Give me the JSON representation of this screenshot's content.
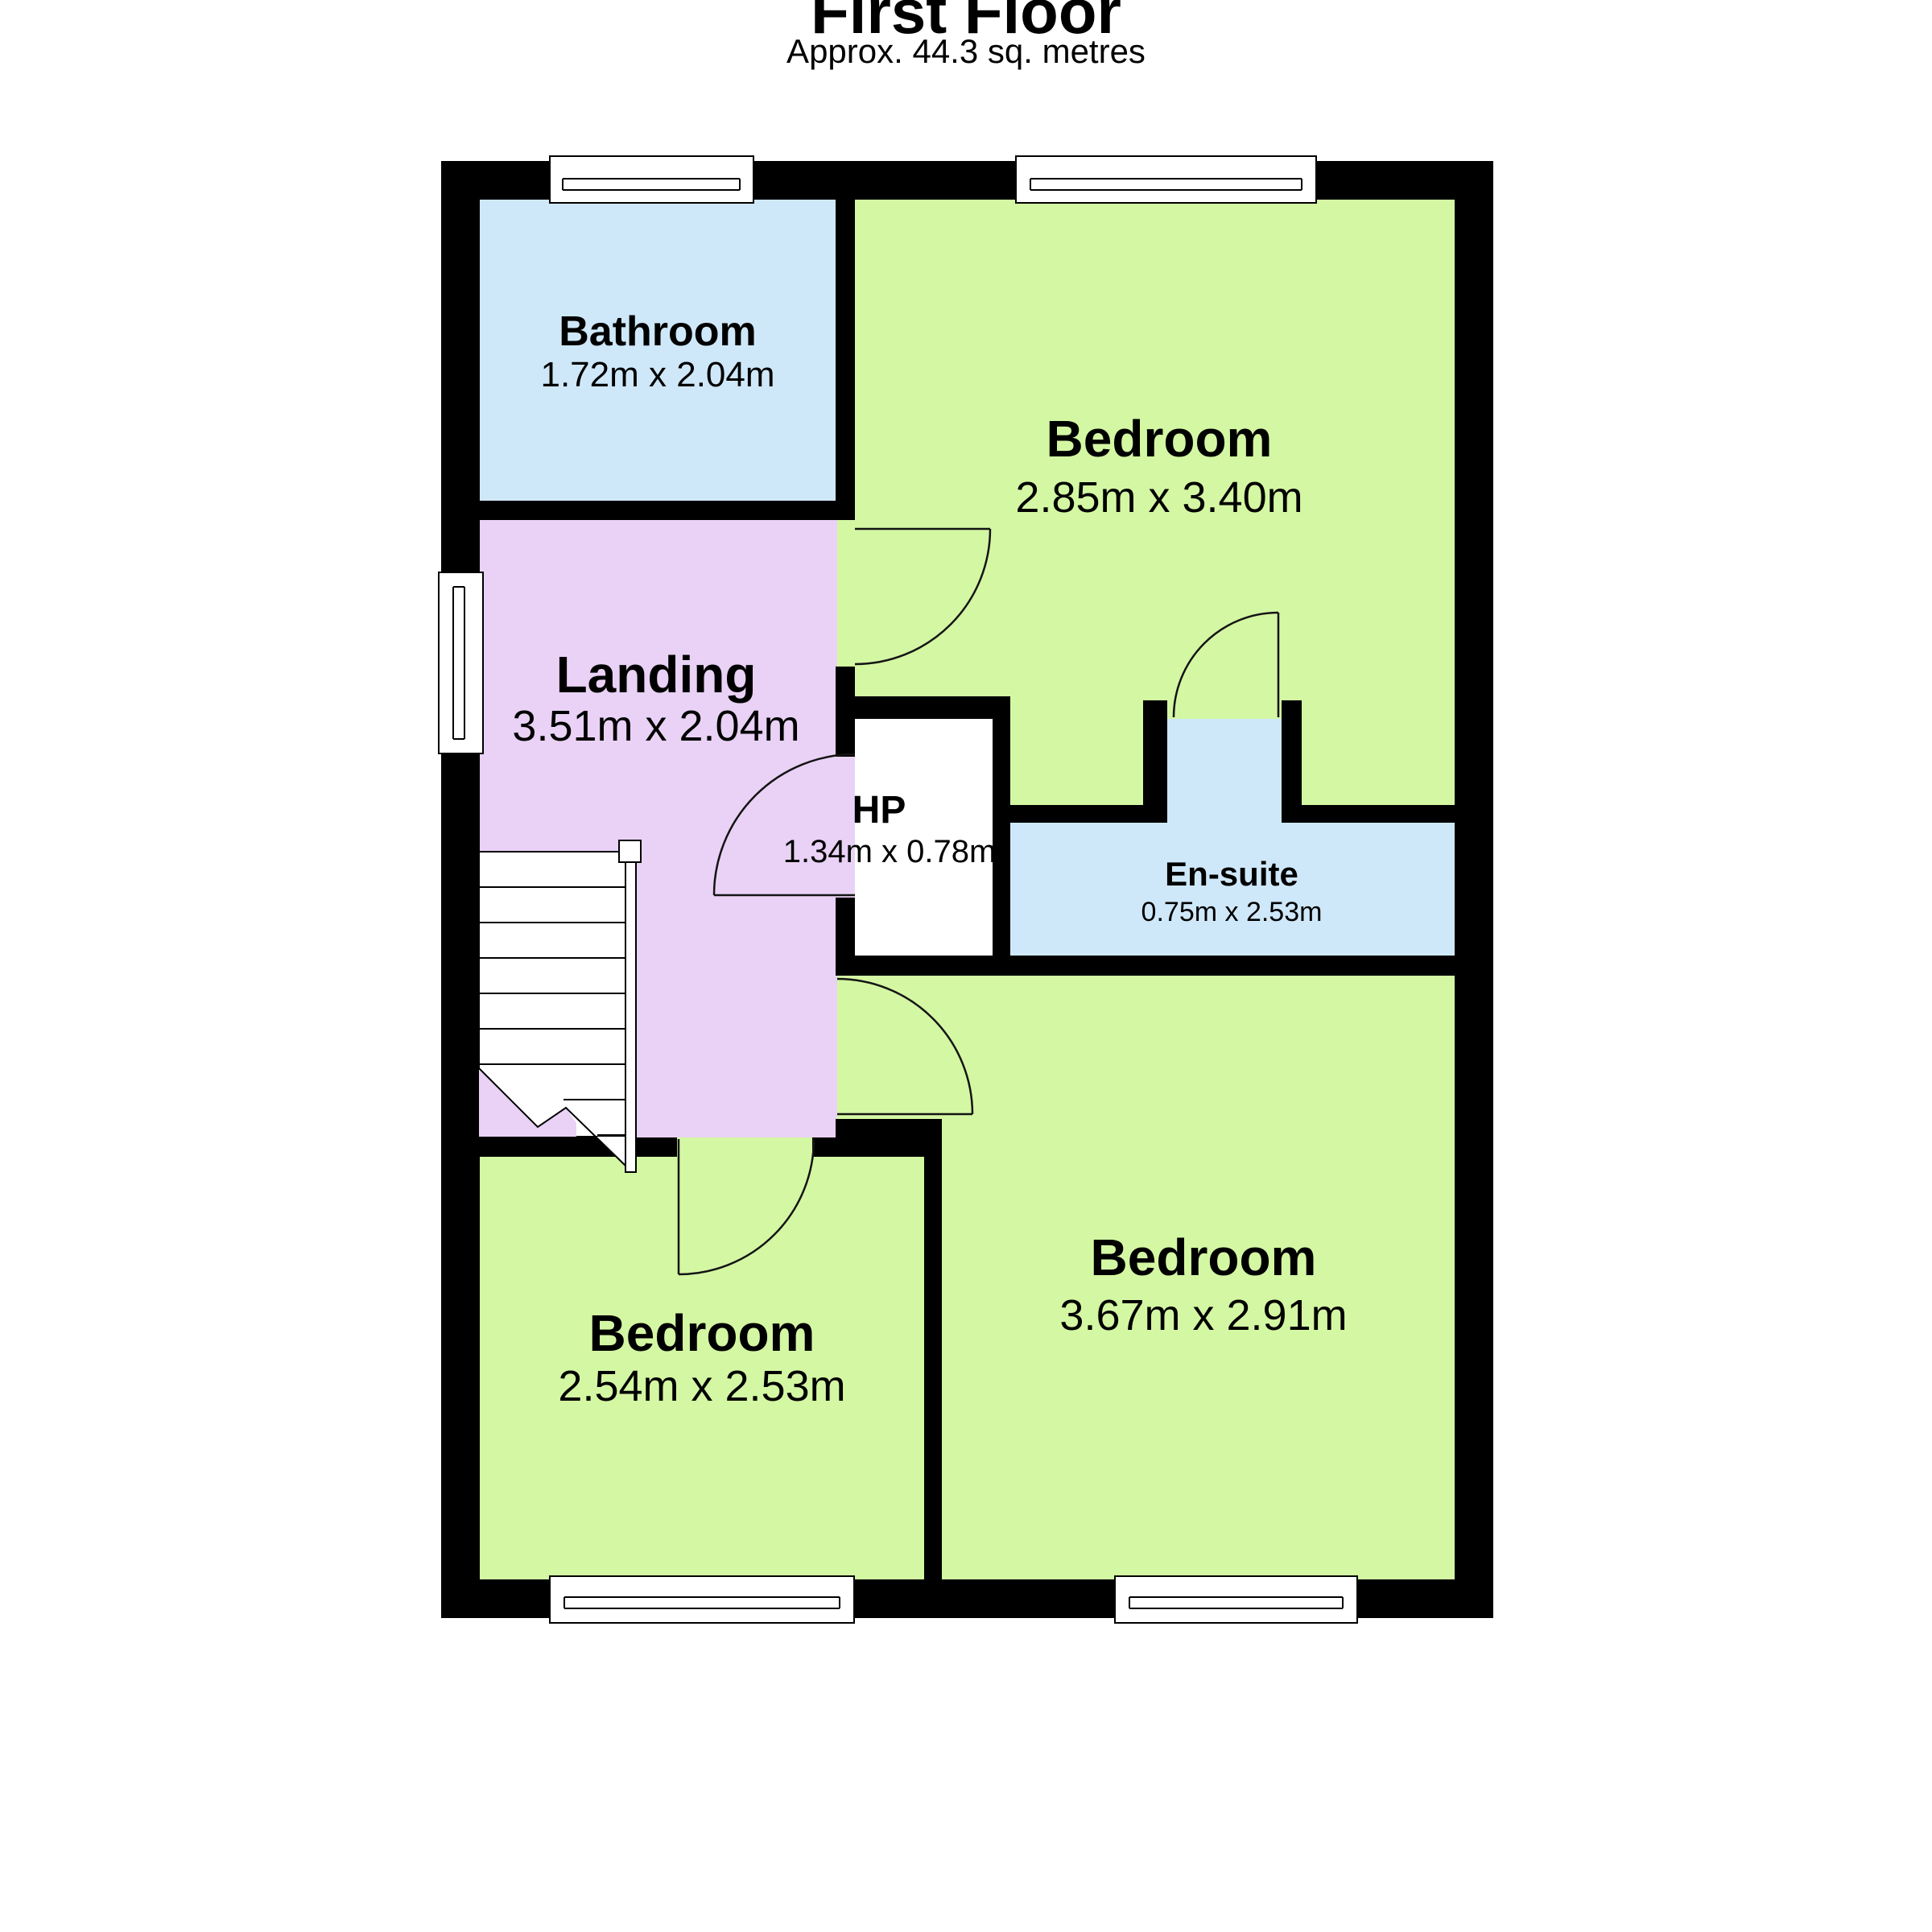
{
  "header": {
    "title": "First Floor",
    "subtitle": "Approx. 44.3 sq. metres"
  },
  "rooms": {
    "bathroom": {
      "name": "Bathroom",
      "dims": "1.72m x 2.04m"
    },
    "bedroom1": {
      "name": "Bedroom",
      "dims": "2.85m x 3.40m"
    },
    "landing": {
      "name": "Landing",
      "dims": "3.51m x 2.04m"
    },
    "hp": {
      "name": "HP",
      "dims": "1.34m x 0.78m"
    },
    "ensuite": {
      "name": "En-suite",
      "dims": "0.75m x 2.53m"
    },
    "bedroom2": {
      "name": "Bedroom",
      "dims": "3.67m x 2.91m"
    },
    "bedroom3": {
      "name": "Bedroom",
      "dims": "2.54m x 2.53m"
    }
  },
  "colors": {
    "bedroom_fill": "#d4f7a3",
    "wet_room_fill": "#cfe8f9",
    "landing_fill": "#e9d2f5",
    "wall": "#000000",
    "background": "#ffffff"
  }
}
